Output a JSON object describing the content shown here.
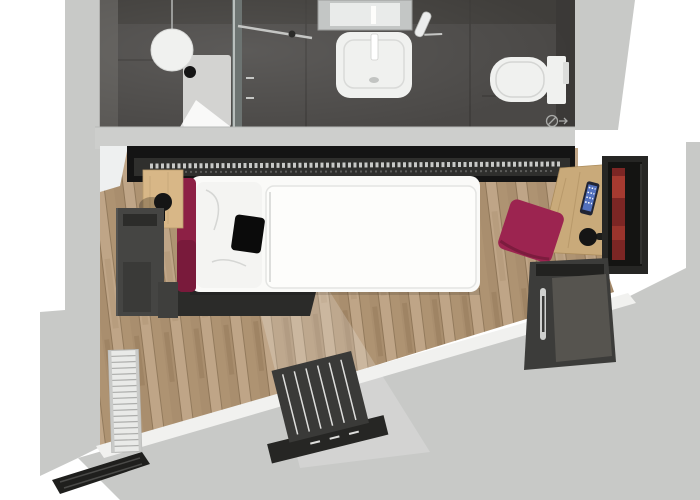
{
  "scene": {
    "kind": "3d-top-view-floor-plan-render",
    "rooms": [
      {
        "id": "bathroom",
        "label": "bathroom"
      },
      {
        "id": "bedroom",
        "label": "bedroom-living-area"
      }
    ],
    "items": [
      {
        "id": "shower",
        "label": "walk-in-shower"
      },
      {
        "id": "pendant-light",
        "label": "globe-pendant-light"
      },
      {
        "id": "shower-glass",
        "label": "glass-partition"
      },
      {
        "id": "washbasin",
        "label": "washbasin-with-faucet"
      },
      {
        "id": "mirror",
        "label": "wall-mirror"
      },
      {
        "id": "hairdryer",
        "label": "hairdryer-holder"
      },
      {
        "id": "toilet",
        "label": "wall-hung-toilet"
      },
      {
        "id": "floor-drain",
        "label": "floor-drain-symbol"
      },
      {
        "id": "wardrobe-rail",
        "label": "open-wardrobe-with-hangers"
      },
      {
        "id": "bed",
        "label": "single-bed"
      },
      {
        "id": "headboard",
        "label": "magenta-headboard"
      },
      {
        "id": "cushion",
        "label": "black-cushion"
      },
      {
        "id": "nightstand",
        "label": "wood-night-shelf"
      },
      {
        "id": "table-lamp",
        "label": "sphere-table-lamp"
      },
      {
        "id": "shelf-cabinet",
        "label": "gray-shelf-unit"
      },
      {
        "id": "desk",
        "label": "wood-desk"
      },
      {
        "id": "smartphone",
        "label": "smartphone-on-desk"
      },
      {
        "id": "desk-lamp",
        "label": "desk-lamp"
      },
      {
        "id": "tv",
        "label": "wall-mounted-tv"
      },
      {
        "id": "ottoman",
        "label": "magenta-ottoman"
      },
      {
        "id": "minibar",
        "label": "minibar-cabinet"
      },
      {
        "id": "radiator",
        "label": "white-radiator"
      },
      {
        "id": "luggage-bench",
        "label": "slatted-luggage-bench"
      },
      {
        "id": "window-sill",
        "label": "window-sill-band"
      },
      {
        "id": "curtain",
        "label": "dark-curtain-rail"
      },
      {
        "id": "entrance-door",
        "label": "entrance-door-leaf"
      }
    ]
  },
  "colors": {
    "background": "#ffffff",
    "wall": "#c8c9c7",
    "wall_shade": "#b7b8b6",
    "divider": "#cdcecc",
    "door": "#f5f5f3",
    "sill": "#f1f1ef",
    "bath_floor": "#4a4846",
    "bath_floor_dark": "#3b3937",
    "bath_wall": "#5a5855",
    "bath_top": "#403e3b",
    "glass": "#6d7472",
    "glass_edge": "#d3d8d6",
    "chrome": "#c5c6c4",
    "tray": "#d3d3d1",
    "fixture": "#f0f1ef",
    "fixture_shade": "#c2c4c2",
    "mirror": "#c3c6c5",
    "mirror_glow": "#e9ebea",
    "drain": "#a9aaa8",
    "wood": "#b49a7b",
    "sheen": "#ffffff",
    "wardrobe": "#141414",
    "wardrobe_inner": "#2f2f2d",
    "hanger": "#d9dad8",
    "bed": "#fafaf8",
    "duvet": "#fdfdfb",
    "pillow": "#f4f4f2",
    "seam": "#d5d6d4",
    "cushion": "#0b0b0b",
    "headboard": "#8d2045",
    "headboard_dark": "#771a3a",
    "ottoman": "#9c2450",
    "nightstand": "#d8b787",
    "lamp": "#151515",
    "cabinet": "#454543",
    "cabinet_dark": "#2c2c2a",
    "bed_base": "#2b2b29",
    "desk": "#c9aa7a",
    "tv_panel": "#262624",
    "tv_frame": "#141412",
    "tv_screen": "#7c2624",
    "tv_screen_hi": "#a63a30",
    "phone": "#202434",
    "phone_screen": "#5d7fd6",
    "minibar": "#3c3c3a",
    "minibar_door": "#56544f",
    "handle": "#d0d1cf",
    "radiator": "#e9eae8",
    "radiator_slat": "#adaeac",
    "bench": "#3a3a38",
    "bench_slat": "#dededc",
    "bench_base": "#262624",
    "curtain": "#1f1f1d",
    "shadow": "#000000"
  }
}
